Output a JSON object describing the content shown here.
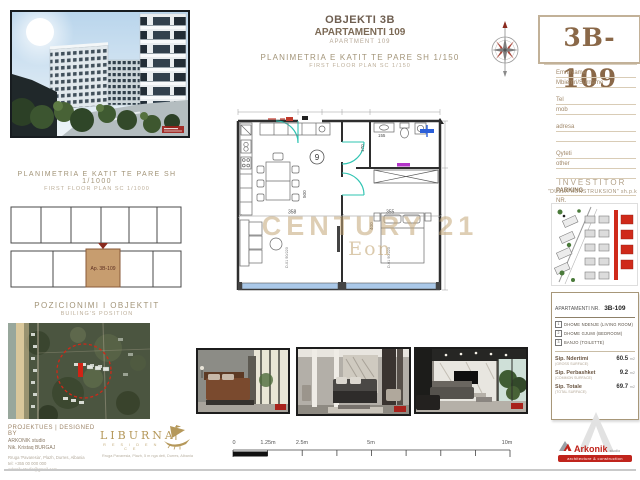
{
  "header": {
    "project": "OBJEKTI 3B",
    "apartment_sq": "APARTAMENTI 109",
    "apartment_en": "APARTMENT 109",
    "plan_title_sq": "PLANIMETRIA E KATIT TE PARE SH 1/150",
    "plan_title_en": "FIRST FLOOR PLAN   SC 1/150"
  },
  "title_block": {
    "unit_code": "3B-109",
    "fields": [
      {
        "label": "Emri/Name"
      },
      {
        "label": "Mbiemri/Surname"
      },
      {
        "label": "Tel"
      },
      {
        "label": "mob"
      },
      {
        "label": "adresa"
      },
      {
        "label": "Qyteti"
      },
      {
        "label": "other"
      },
      {
        "label": "PARKING"
      },
      {
        "label": "NR."
      }
    ]
  },
  "investor": {
    "heading": "INVESTITOR",
    "name": "\"DULLA KONSTRUKSION\" sh.p.k"
  },
  "apartment_info": {
    "heading": "APARTAMENTI NR.",
    "code": "3B-109",
    "rooms": [
      {
        "num": "1",
        "name": "DHOME NDENJE (LIVING ROOM)"
      },
      {
        "num": "2",
        "name": "DHOME GJUMI (BEDROOM)"
      },
      {
        "num": "3",
        "name": "BANJO (TOILETTE)"
      }
    ],
    "areas": [
      {
        "label": "Sip. Ndertimi",
        "sub": "(GROSS SURFACE)",
        "value": "60.5",
        "unit": "m2"
      },
      {
        "label": "Sip. Perbashket",
        "sub": "(COMMON SURFACE)",
        "value": "9.2",
        "unit": "m2"
      },
      {
        "label": "Sip. Totale",
        "sub": "(TOTAL SURFACE)",
        "value": "69.7",
        "unit": "m2"
      }
    ]
  },
  "key_plan": {
    "title": "PLANIMETRIA E KATIT TE PARE SH 1/1000",
    "subtitle": "FIRST FLOOR PLAN   SC 1/1000",
    "highlight_label": "Ap. 3B-109"
  },
  "position_map": {
    "title": "POZICIONIMI I OBJEKTIT",
    "subtitle": "BUILING'S POSITION"
  },
  "designer": {
    "heading": "PROJEKTUES | DESIGNED BY",
    "line1": "ARKONIK studio",
    "line2": "Nik. Kristaq BURGAJ",
    "address": "Rruga 'Pavaresia', Plazh, Durres, Albania",
    "tel": "tel: +355 00 000 000",
    "email": "arkonik.studio@gmail.com"
  },
  "liburna": {
    "name": "LIBURNA",
    "subtitle": "R E S I D E N C E",
    "address": "Rruga Pavaresia, Plazh, 5 m nga deti, Durres, Albania"
  },
  "scale_bar": {
    "labels": [
      "0",
      "1.25m",
      "2.5m",
      "5m",
      "10m"
    ]
  },
  "floor_plan": {
    "room_number": "9",
    "watermark": "CENTURY 21",
    "watermark_sub": "Eon",
    "dim_left_width": "358",
    "dim_right_width": "355",
    "dim_left_height": "500",
    "dim_right_height": "400",
    "dim_hall": "170",
    "dim_bath": "155",
    "door_left": "D-01  90/220",
    "door_right": "D-01  90/220"
  },
  "arkonik": {
    "name": "Arkonik",
    "suffix": "studio",
    "tagline": "architecture & construction"
  }
}
